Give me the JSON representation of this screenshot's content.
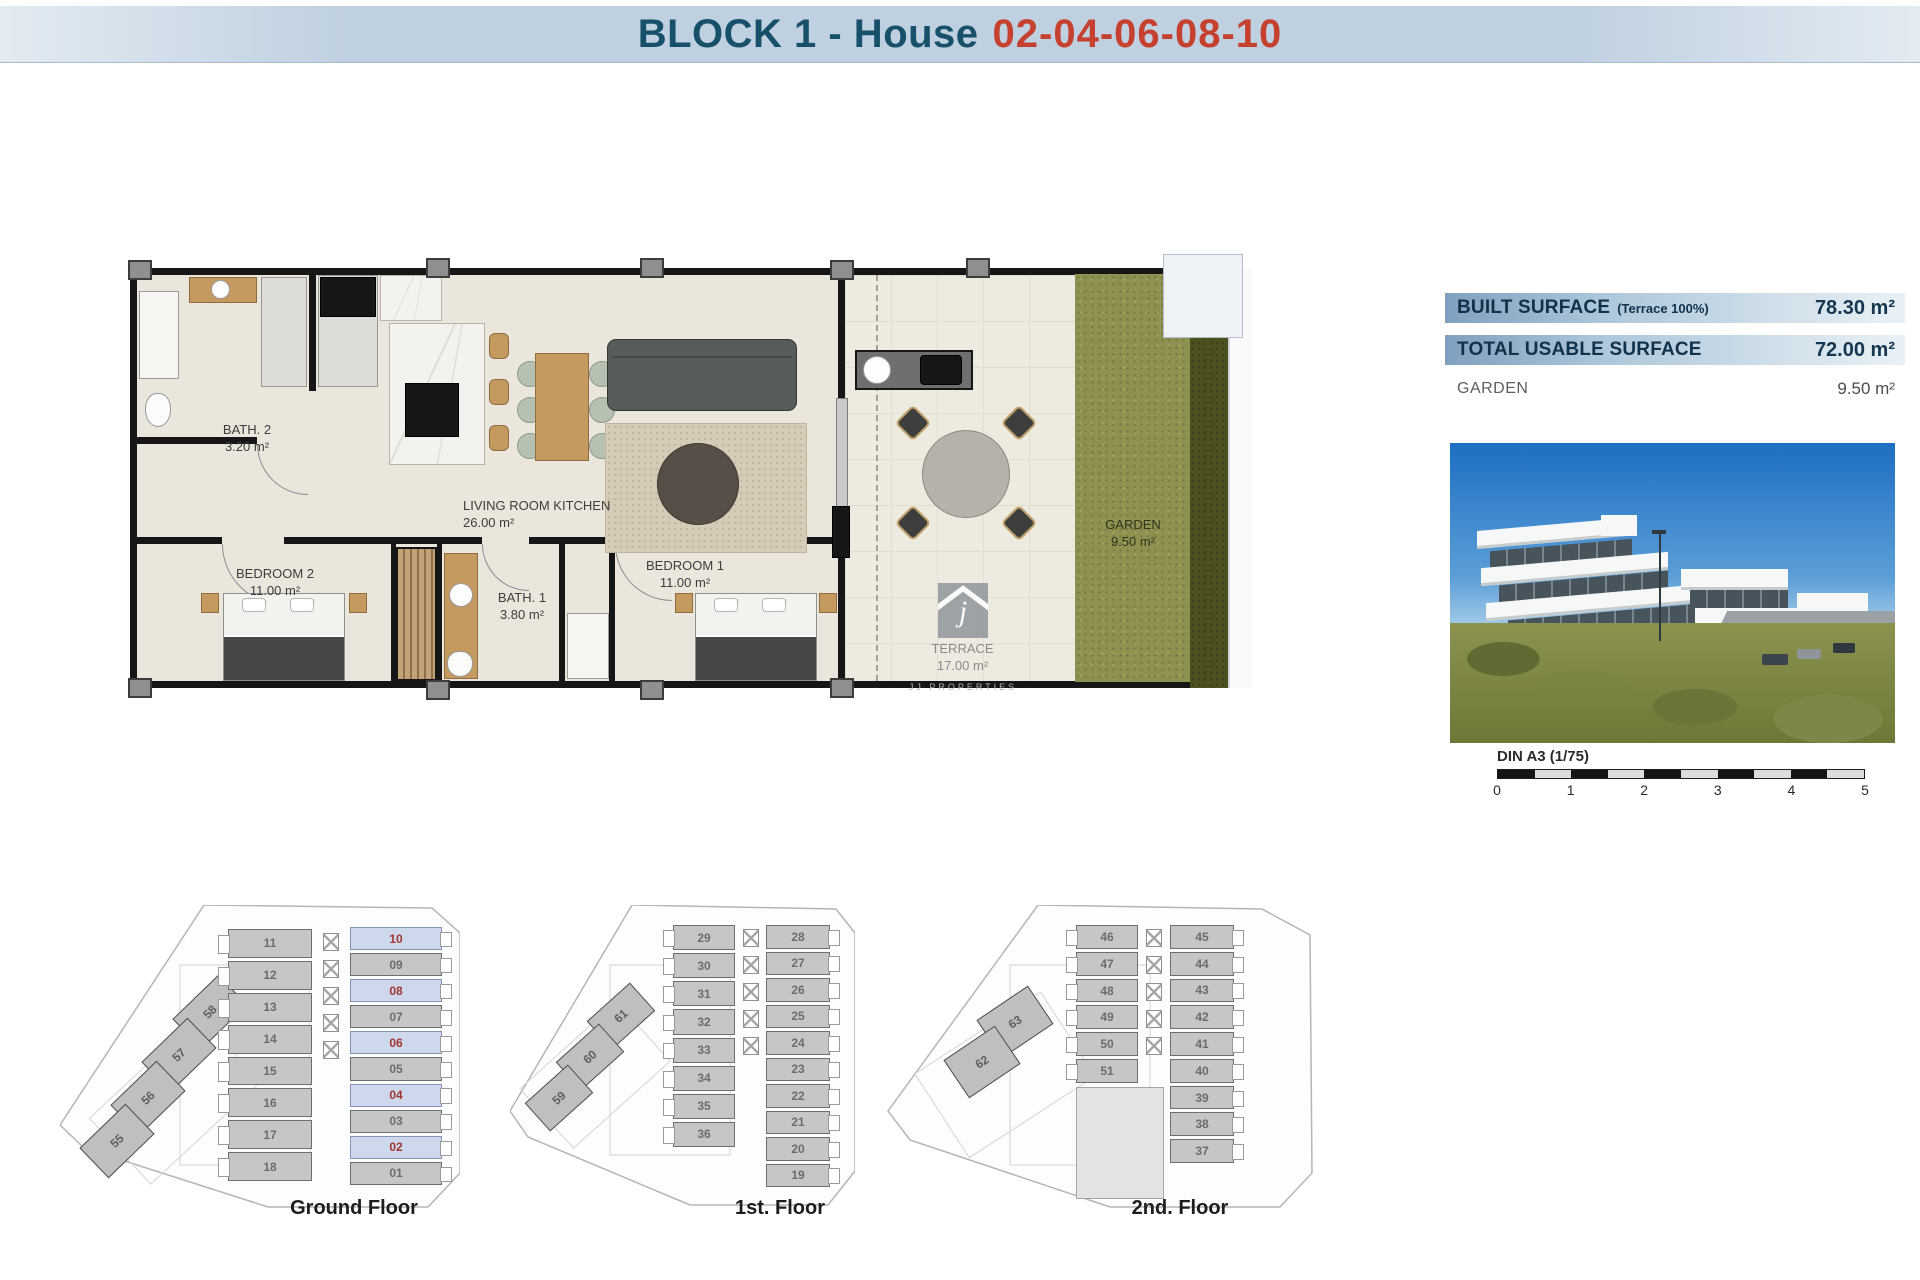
{
  "header": {
    "title_left": "BLOCK 1 - House",
    "title_right": "02-04-06-08-10"
  },
  "colors": {
    "header_bar": "#bfd0e0",
    "header_text": "#17506a",
    "header_accent": "#c6402f",
    "table_bar": "#7fa0bf",
    "highlight_unit_bg": "#cdd8ec",
    "highlight_unit_text": "#a23530",
    "garden_green": "#8f9151"
  },
  "floor_plan": {
    "rooms": [
      {
        "name": "BATH. 2",
        "area": "3.20 m²"
      },
      {
        "name": "LIVING ROOM KITCHEN",
        "area": "26.00 m²"
      },
      {
        "name": "BEDROOM 2",
        "area": "11.00 m²"
      },
      {
        "name": "BATH. 1",
        "area": "3.80 m²"
      },
      {
        "name": "BEDROOM 1",
        "area": "11.00 m²"
      },
      {
        "name": "TERRACE",
        "area": "17.00 m²"
      },
      {
        "name": "GARDEN",
        "area": "9.50 m²"
      }
    ],
    "watermark": "JJ PROPERTIES",
    "watermark_letter": "j"
  },
  "surface_table": {
    "rows": [
      {
        "label": "BUILT SURFACE",
        "note": "(Terrace 100%)",
        "value": "78.30 m²"
      },
      {
        "label": "TOTAL USABLE SURFACE",
        "note": "",
        "value": "72.00 m²"
      },
      {
        "label": "GARDEN",
        "note": "",
        "value": "9.50 m²"
      }
    ]
  },
  "scale_bar": {
    "label": "DIN A3 (1/75)",
    "ticks": [
      "0",
      "1",
      "2",
      "3",
      "4",
      "5"
    ]
  },
  "floors": [
    {
      "label": "Ground Floor",
      "left_units": [
        "11",
        "12",
        "13",
        "14",
        "15",
        "16",
        "17",
        "18"
      ],
      "right_units": [
        "10",
        "09",
        "08",
        "07",
        "06",
        "05",
        "04",
        "03",
        "02",
        "01"
      ],
      "diagonal_units": [
        "58",
        "57",
        "56",
        "55"
      ],
      "highlighted": [
        "10",
        "08",
        "06",
        "04",
        "02"
      ]
    },
    {
      "label": "1st. Floor",
      "left_units": [
        "29",
        "30",
        "31",
        "32",
        "33",
        "34",
        "35",
        "36"
      ],
      "right_units": [
        "28",
        "27",
        "26",
        "25",
        "24",
        "23",
        "22",
        "21",
        "20",
        "19"
      ],
      "diagonal_units": [
        "61",
        "60",
        "59"
      ],
      "highlighted": []
    },
    {
      "label": "2nd. Floor",
      "left_units": [
        "46",
        "47",
        "48",
        "49",
        "50",
        "51"
      ],
      "right_units": [
        "45",
        "44",
        "43",
        "42",
        "41",
        "40",
        "39",
        "38",
        "37"
      ],
      "diagonal_units": [
        "63",
        "62"
      ],
      "highlighted": []
    }
  ]
}
